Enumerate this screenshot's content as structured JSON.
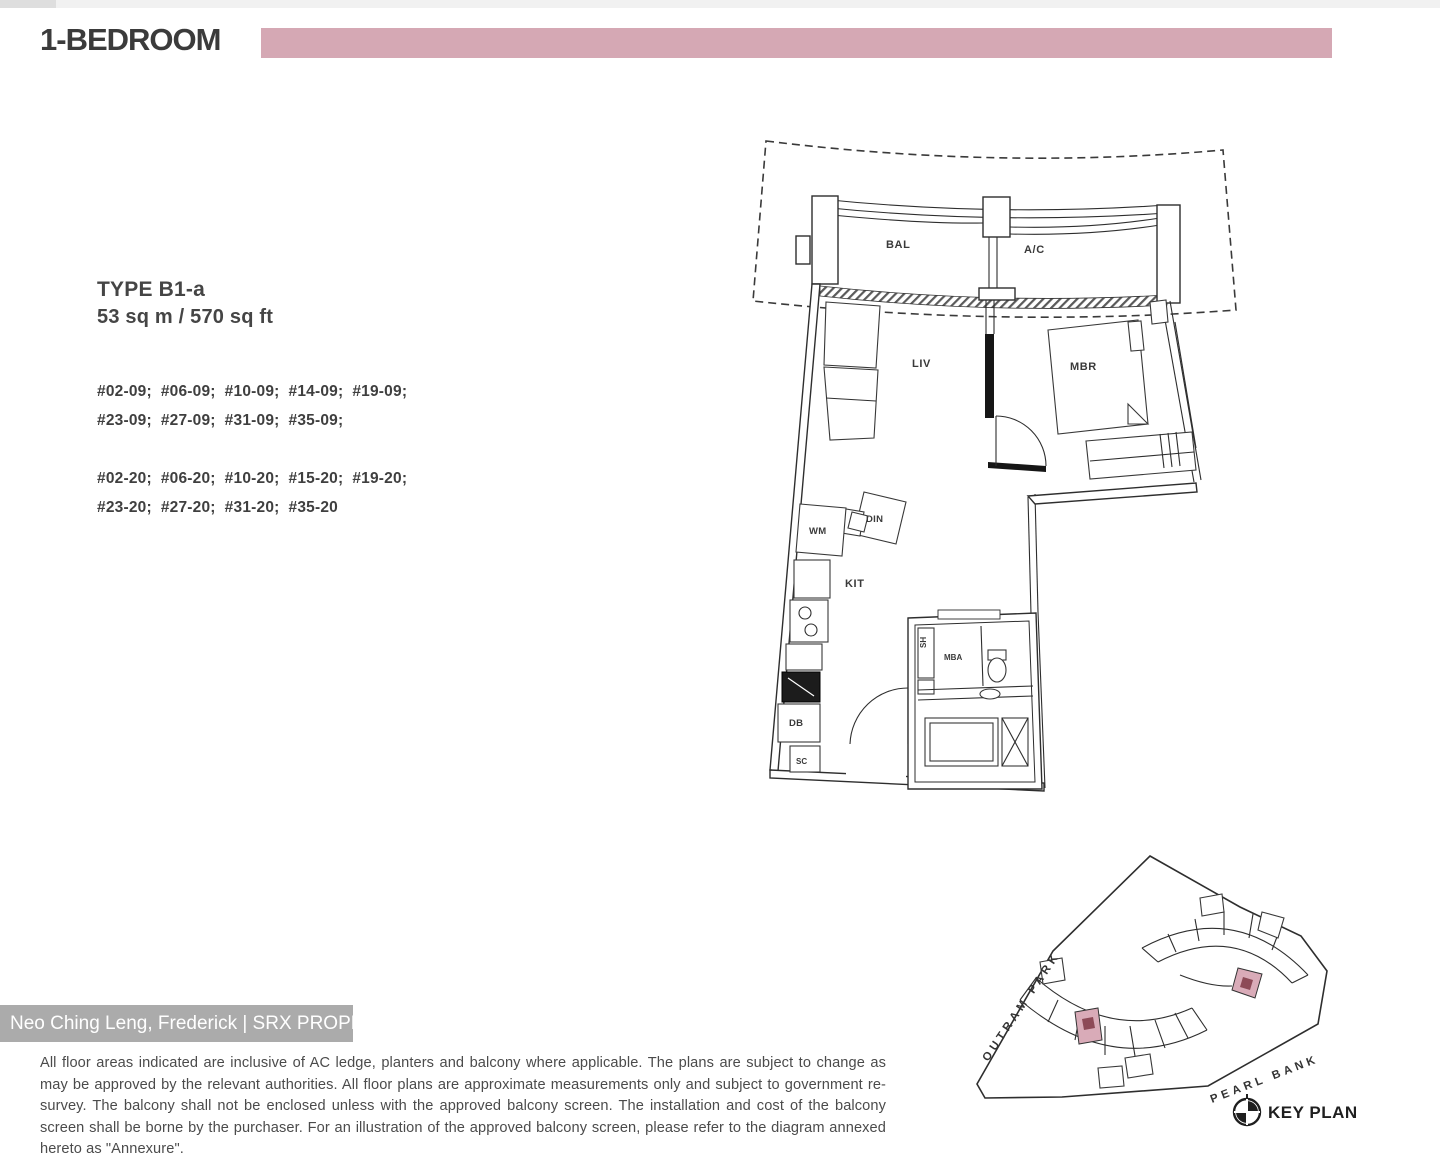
{
  "header": {
    "title": "1-BEDROOM"
  },
  "unit": {
    "type": "TYPE B1-a",
    "area": "53 sq m / 570 sq ft",
    "stack09_line1": "#02-09;  #06-09;  #10-09;  #14-09;  #19-09;",
    "stack09_line2": "#23-09;  #27-09;  #31-09;  #35-09;",
    "stack20_line1": "#02-20;  #06-20;  #10-20;  #15-20;  #19-20;",
    "stack20_line2": "#23-20;  #27-20;  #31-20;  #35-20"
  },
  "floorplan": {
    "labels": {
      "bal": "BAL",
      "ac": "A/C",
      "liv": "LIV",
      "mbr": "MBR",
      "wm": "WM",
      "din": "DIN",
      "kit": "KIT",
      "db": "DB",
      "sc": "SC",
      "sh": "SH",
      "mba": "MBA"
    }
  },
  "keyplan": {
    "street_outram": "OUTRAM PARK",
    "street_pearl": "PEARL BANK",
    "title": "KEY PLAN"
  },
  "watermark": {
    "text": "Neo Ching Leng, Frederick | SRX PROPERTY"
  },
  "disclaimer": {
    "text": "All floor areas indicated are inclusive of AC ledge, planters and balcony where applicable. The plans are subject to change as may be approved by the relevant authorities. All floor plans are approximate measurements only and subject to government re-survey. The balcony shall not be enclosed unless with the approved balcony screen. The installation and cost of the balcony screen shall be borne by the purchaser. For an illustration of the approved balcony screen, please refer to the diagram annexed hereto as \"Annexure\"."
  },
  "colors": {
    "banner": "#d5a8b4",
    "highlight": "#d9abb8",
    "highlight_dark": "#8d4a57",
    "watermark_bg": "#ababab"
  }
}
